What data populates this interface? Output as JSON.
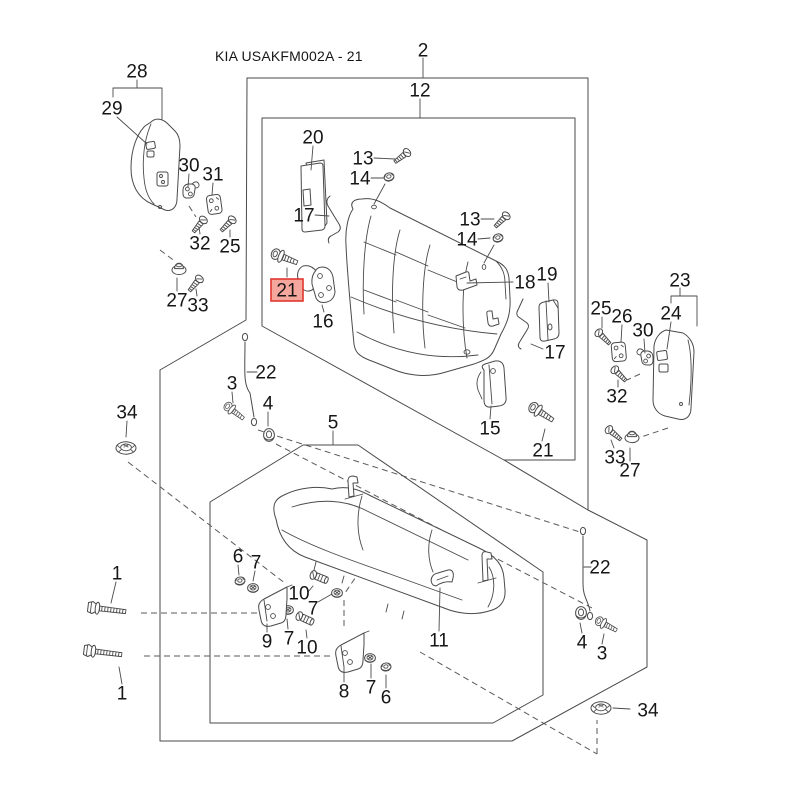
{
  "title": "KIA USAKFM002A - 21",
  "diagram": {
    "type": "exploded-parts-diagram",
    "subject": "rear seat assembly",
    "highlighted_part": "21",
    "background": "#FFFFFF",
    "line_color": "#4A4A4A",
    "label_color": "#161616",
    "highlight": {
      "fill": "#F5A79E",
      "border": "#E0372E",
      "text_color": "#7E211A"
    },
    "part_labels": [
      {
        "text": "2",
        "x": 423,
        "y": 50
      },
      {
        "text": "12",
        "x": 420,
        "y": 90
      },
      {
        "text": "28",
        "x": 137,
        "y": 71
      },
      {
        "text": "29",
        "x": 112,
        "y": 108
      },
      {
        "text": "30",
        "x": 189,
        "y": 165
      },
      {
        "text": "31",
        "x": 213,
        "y": 174
      },
      {
        "text": "32",
        "x": 200,
        "y": 243
      },
      {
        "text": "25",
        "x": 230,
        "y": 246
      },
      {
        "text": "27",
        "x": 177,
        "y": 300
      },
      {
        "text": "33",
        "x": 198,
        "y": 305
      },
      {
        "text": "20",
        "x": 313,
        "y": 137
      },
      {
        "text": "13",
        "x": 363,
        "y": 158
      },
      {
        "text": "14",
        "x": 360,
        "y": 178
      },
      {
        "text": "17",
        "x": 304,
        "y": 215
      },
      {
        "text": "16",
        "x": 323,
        "y": 321
      },
      {
        "text": "21",
        "x": 287,
        "y": 290,
        "highlighted": true
      },
      {
        "text": "13",
        "x": 470,
        "y": 219
      },
      {
        "text": "14",
        "x": 467,
        "y": 239
      },
      {
        "text": "18",
        "x": 525,
        "y": 282
      },
      {
        "text": "19",
        "x": 547,
        "y": 274
      },
      {
        "text": "17",
        "x": 555,
        "y": 352
      },
      {
        "text": "15",
        "x": 490,
        "y": 428
      },
      {
        "text": "21",
        "x": 543,
        "y": 450
      },
      {
        "text": "23",
        "x": 680,
        "y": 280
      },
      {
        "text": "24",
        "x": 671,
        "y": 313
      },
      {
        "text": "25",
        "x": 601,
        "y": 308
      },
      {
        "text": "26",
        "x": 622,
        "y": 316
      },
      {
        "text": "30",
        "x": 643,
        "y": 330
      },
      {
        "text": "32",
        "x": 617,
        "y": 396
      },
      {
        "text": "33",
        "x": 615,
        "y": 457
      },
      {
        "text": "27",
        "x": 630,
        "y": 470
      },
      {
        "text": "22",
        "x": 600,
        "y": 567
      },
      {
        "text": "4",
        "x": 582,
        "y": 642
      },
      {
        "text": "3",
        "x": 602,
        "y": 653
      },
      {
        "text": "34",
        "x": 648,
        "y": 710
      },
      {
        "text": "34",
        "x": 127,
        "y": 412
      },
      {
        "text": "3",
        "x": 232,
        "y": 383
      },
      {
        "text": "22",
        "x": 266,
        "y": 372
      },
      {
        "text": "4",
        "x": 268,
        "y": 403
      },
      {
        "text": "5",
        "x": 333,
        "y": 422
      },
      {
        "text": "1",
        "x": 117,
        "y": 573
      },
      {
        "text": "1",
        "x": 122,
        "y": 693
      },
      {
        "text": "6",
        "x": 238,
        "y": 556
      },
      {
        "text": "7",
        "x": 256,
        "y": 562
      },
      {
        "text": "10",
        "x": 299,
        "y": 593
      },
      {
        "text": "7",
        "x": 313,
        "y": 608
      },
      {
        "text": "9",
        "x": 267,
        "y": 641
      },
      {
        "text": "7",
        "x": 289,
        "y": 638
      },
      {
        "text": "10",
        "x": 307,
        "y": 647
      },
      {
        "text": "8",
        "x": 344,
        "y": 691
      },
      {
        "text": "7",
        "x": 371,
        "y": 687
      },
      {
        "text": "6",
        "x": 386,
        "y": 697
      },
      {
        "text": "11",
        "x": 439,
        "y": 640
      }
    ]
  }
}
